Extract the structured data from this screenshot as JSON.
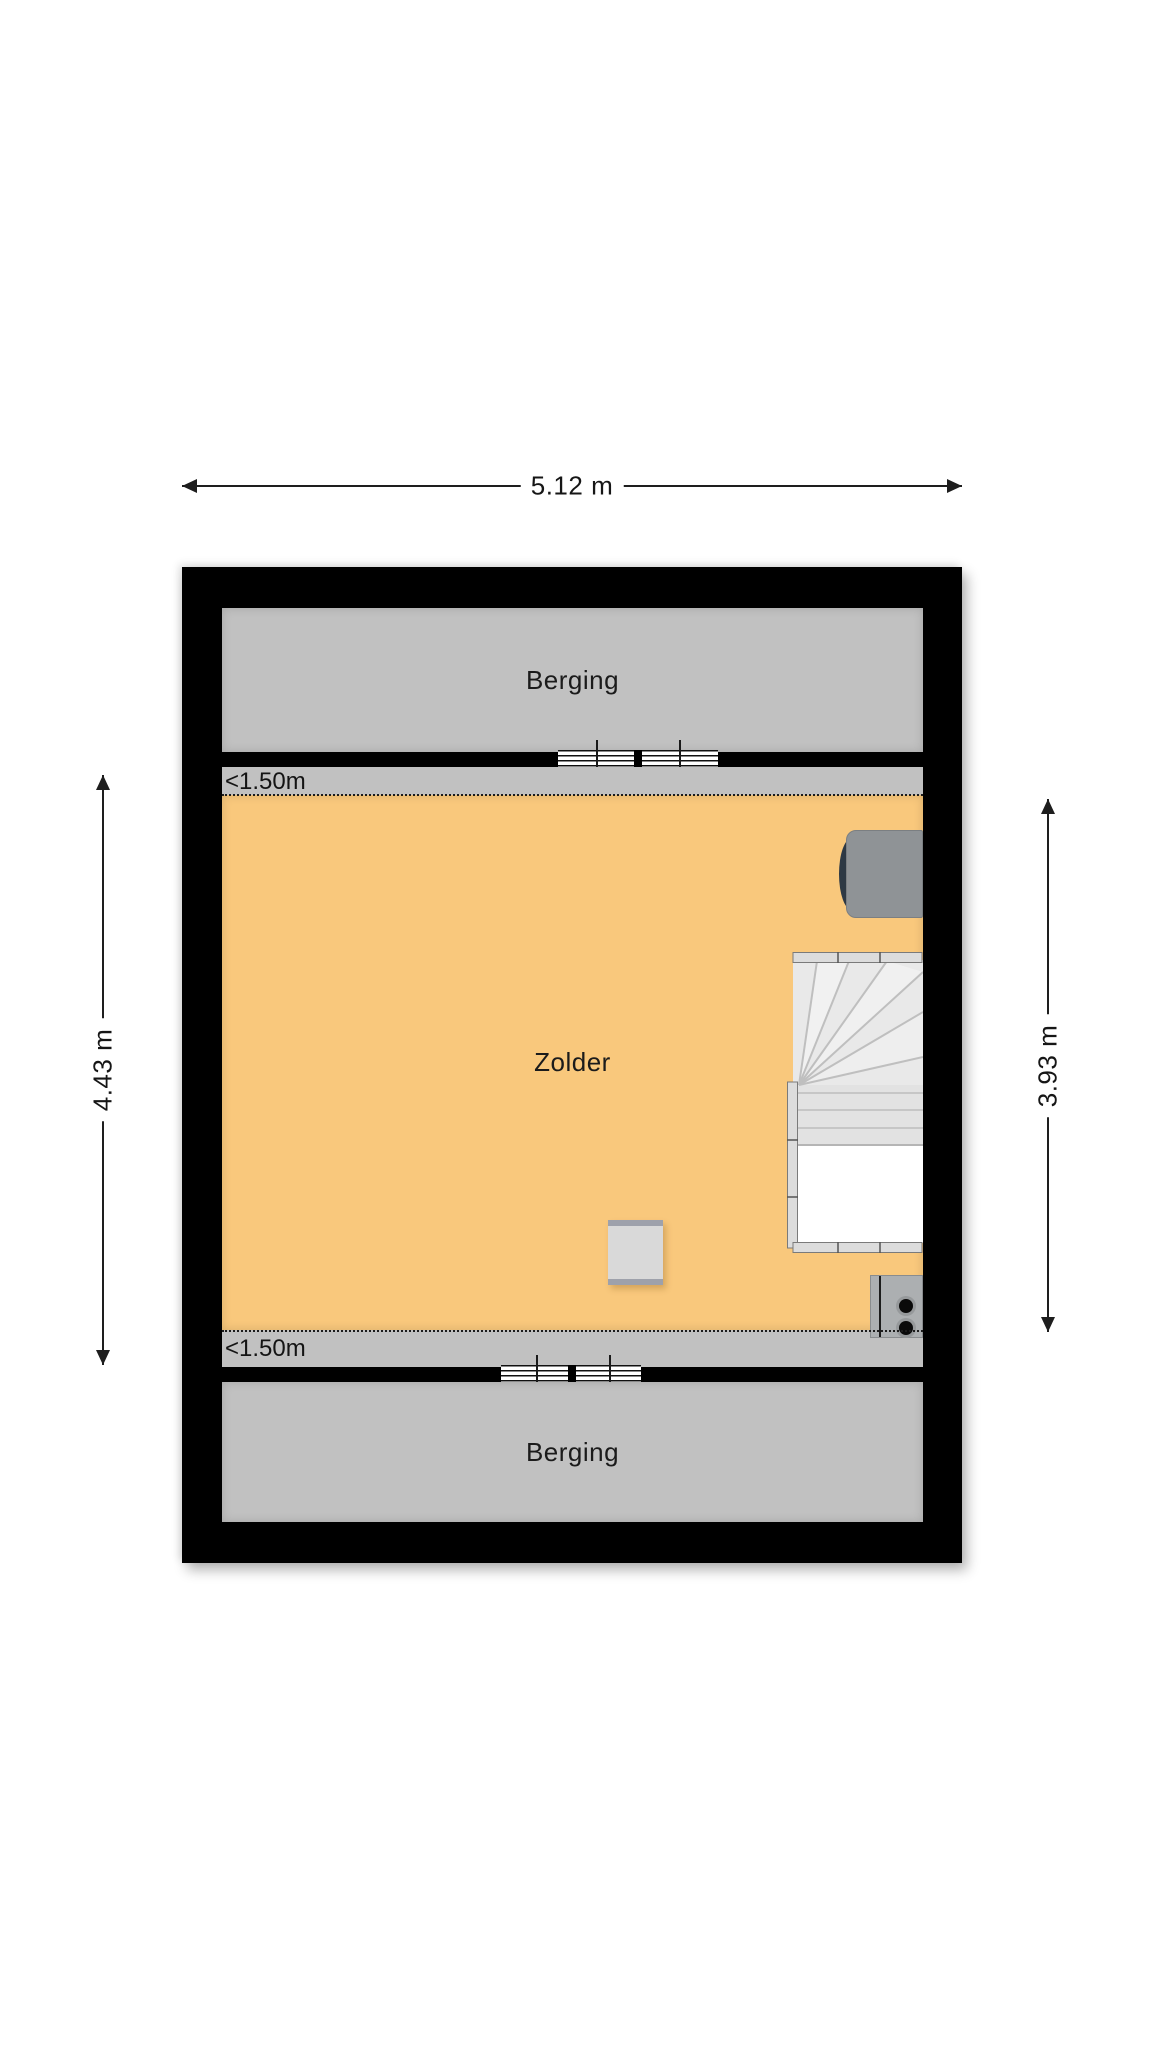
{
  "dimensions": {
    "top": "5.12 m",
    "left": "4.43 m",
    "right": "3.93 m"
  },
  "rooms": {
    "berging_top": "Berging",
    "zolder": "Zolder",
    "berging_bottom": "Berging"
  },
  "annotations": {
    "low_height_top": "<1.50m",
    "low_height_bottom": "<1.50m"
  },
  "colors": {
    "wall": "#000000",
    "room_gray": "#C1C1C1",
    "attic_orange": "#F9C87C",
    "stair_fill": "#E9E9E9",
    "dimension_line": "#1e1e1e"
  }
}
